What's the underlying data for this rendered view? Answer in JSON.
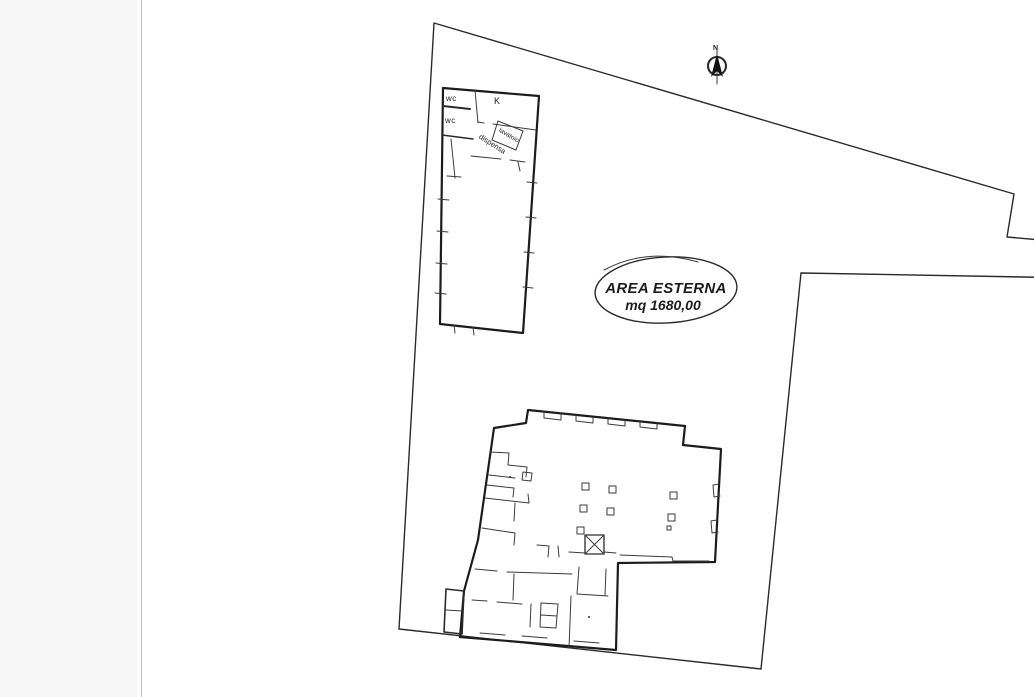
{
  "window": {
    "background": "#ffffff",
    "sidebar_color": "#f7f7f7",
    "divider_color": "#c5c5c9",
    "ink_color": "#2a2a2a"
  },
  "floor_plan": {
    "north_label": "N",
    "outdoor_area_label": {
      "line1": "AREA ESTERNA",
      "line2": "mq 1680,00"
    },
    "annex_labels": {
      "wc_top": "wc",
      "wc_bottom": "wc",
      "kitchen": "K",
      "laundry_room": "lavatoio",
      "pantry": "dispensa"
    }
  }
}
